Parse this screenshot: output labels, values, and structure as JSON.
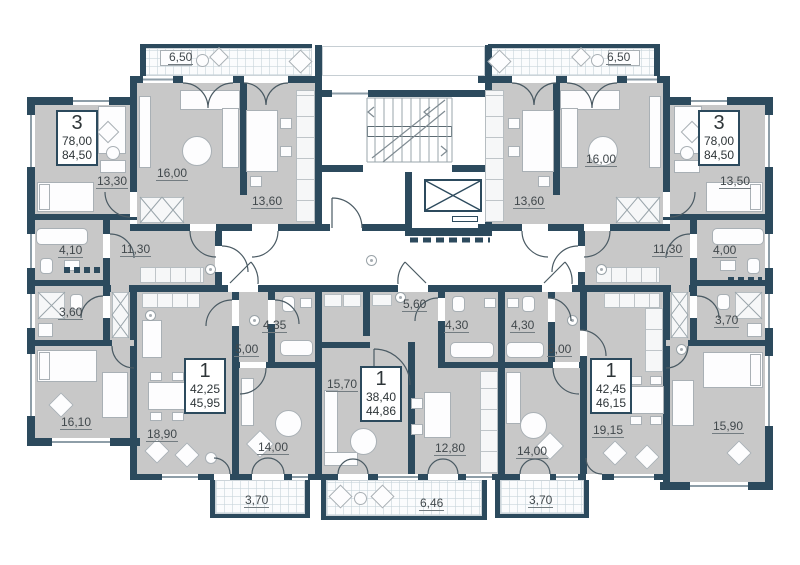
{
  "plan_title": "Residential floor plan",
  "colors": {
    "wall": "#2c4a5d",
    "room_fill": "#c8c8c8",
    "corridor": "#ffffff",
    "label_text": "#41484c"
  },
  "apartments": [
    {
      "rooms": "3",
      "area_living": "78,00",
      "area_total": "84,50"
    },
    {
      "rooms": "3",
      "area_living": "78,00",
      "area_total": "84,50"
    },
    {
      "rooms": "1",
      "area_living": "42,25",
      "area_total": "45,95"
    },
    {
      "rooms": "1",
      "area_living": "38,40",
      "area_total": "44,86"
    },
    {
      "rooms": "1",
      "area_living": "42,45",
      "area_total": "46,15"
    }
  ],
  "room_labels": [
    {
      "t": "6,50",
      "x": 168,
      "y": 50
    },
    {
      "t": "6,50",
      "x": 606,
      "y": 50
    },
    {
      "t": "13,30",
      "x": 96,
      "y": 174
    },
    {
      "t": "16,00",
      "x": 156,
      "y": 166
    },
    {
      "t": "13,60",
      "x": 251,
      "y": 194
    },
    {
      "t": "16,00",
      "x": 585,
      "y": 152
    },
    {
      "t": "13,50",
      "x": 719,
      "y": 174
    },
    {
      "t": "13,60",
      "x": 513,
      "y": 194
    },
    {
      "t": "4,10",
      "x": 58,
      "y": 243
    },
    {
      "t": "11,30",
      "x": 120,
      "y": 242
    },
    {
      "t": "11,30",
      "x": 652,
      "y": 242
    },
    {
      "t": "4,00",
      "x": 712,
      "y": 243
    },
    {
      "t": "3,60",
      "x": 58,
      "y": 305
    },
    {
      "t": "3,70",
      "x": 714,
      "y": 313
    },
    {
      "t": "16,10",
      "x": 60,
      "y": 415
    },
    {
      "t": "15,90",
      "x": 712,
      "y": 419
    },
    {
      "t": "18,90",
      "x": 146,
      "y": 427
    },
    {
      "t": "5,00",
      "x": 234,
      "y": 342
    },
    {
      "t": "4,35",
      "x": 262,
      "y": 318
    },
    {
      "t": "14,00",
      "x": 257,
      "y": 440
    },
    {
      "t": "15,70",
      "x": 326,
      "y": 377
    },
    {
      "t": "5,60",
      "x": 402,
      "y": 297
    },
    {
      "t": "4,30",
      "x": 444,
      "y": 318
    },
    {
      "t": "12,80",
      "x": 434,
      "y": 441
    },
    {
      "t": "4,30",
      "x": 510,
      "y": 318
    },
    {
      "t": "5,00",
      "x": 547,
      "y": 342
    },
    {
      "t": "14,00",
      "x": 516,
      "y": 444
    },
    {
      "t": "19,15",
      "x": 592,
      "y": 423
    },
    {
      "t": "3,70",
      "x": 244,
      "y": 493
    },
    {
      "t": "6,46",
      "x": 419,
      "y": 496
    },
    {
      "t": "3,70",
      "x": 528,
      "y": 493
    }
  ]
}
